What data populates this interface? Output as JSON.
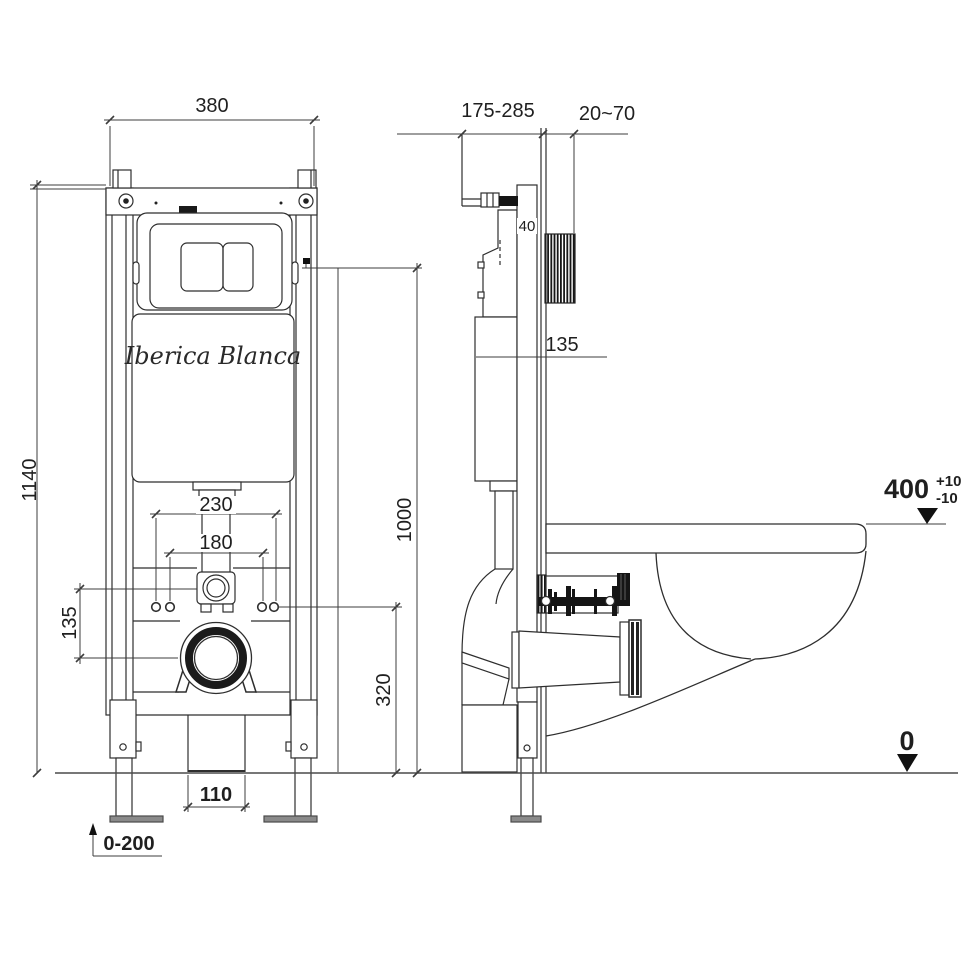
{
  "drawing": {
    "brand": "Iberica Blanca",
    "dims": {
      "front": {
        "width": "380",
        "height": "1140",
        "bolt_outer": "230",
        "bolt_inner": "180",
        "inlet_offset": "135",
        "fixing_height": "320",
        "flush_height": "1000",
        "outlet_width": "110",
        "leg_range": "0-200"
      },
      "side": {
        "depth_range": "175-285",
        "shaft_range": "20~70",
        "rail_depth": "40",
        "tank_level": "135",
        "rim_height": "400",
        "tol_plus": "+10",
        "tol_minus": "-10",
        "floor": "0"
      }
    },
    "colors": {
      "line": "#2e2e2e",
      "dim_line": "#3c3c3c",
      "dark_fill": "#151515",
      "foot_fill": "#8a8a8a"
    }
  }
}
